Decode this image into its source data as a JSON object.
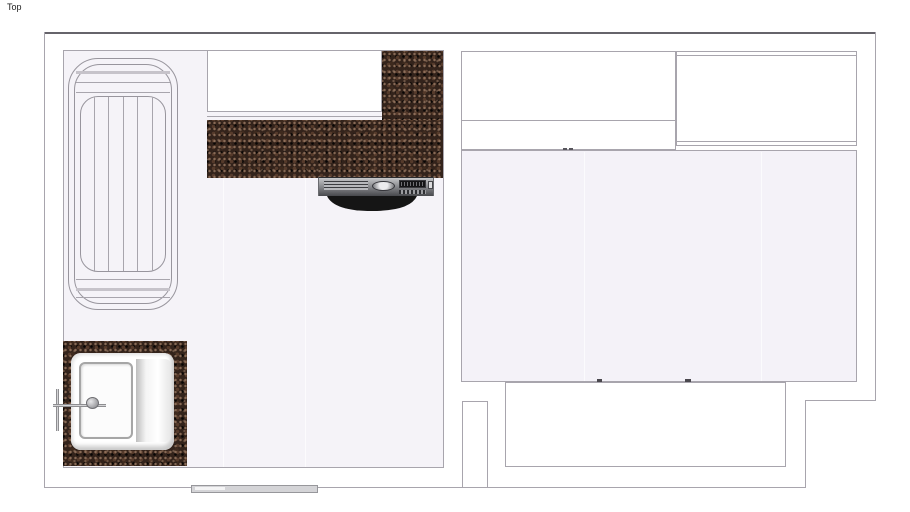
{
  "viewport": {
    "view_label": "Top"
  },
  "scene": {
    "type": "floor-plan-top-view",
    "rooms": [
      {
        "name": "kitchen",
        "fixtures": [
          "drying-rack",
          "counter-cabinet",
          "granite-countertop-l-shape",
          "oven-with-handle",
          "granite-sink-counter",
          "sink-with-drainboard",
          "faucet",
          "door-sill"
        ]
      },
      {
        "name": "adjacent-room",
        "fixtures": [
          "cabinet-left",
          "cabinet-right",
          "floor-panels",
          "wall-pillar",
          "balcony-inset"
        ]
      }
    ],
    "colors": {
      "background": "#ffffff",
      "wall_line": "#a8a5ad",
      "outer_wall_line": "#66646b",
      "kitchen_floor": "#f5f3f8",
      "room_floor": "#f4f2f8",
      "granite_base": "#33231b",
      "oven_panel_light": "#c6c7c9",
      "oven_panel_dark": "#47484c",
      "oven_handle": "#0b0b0b",
      "sink_white": "#ffffff"
    }
  }
}
